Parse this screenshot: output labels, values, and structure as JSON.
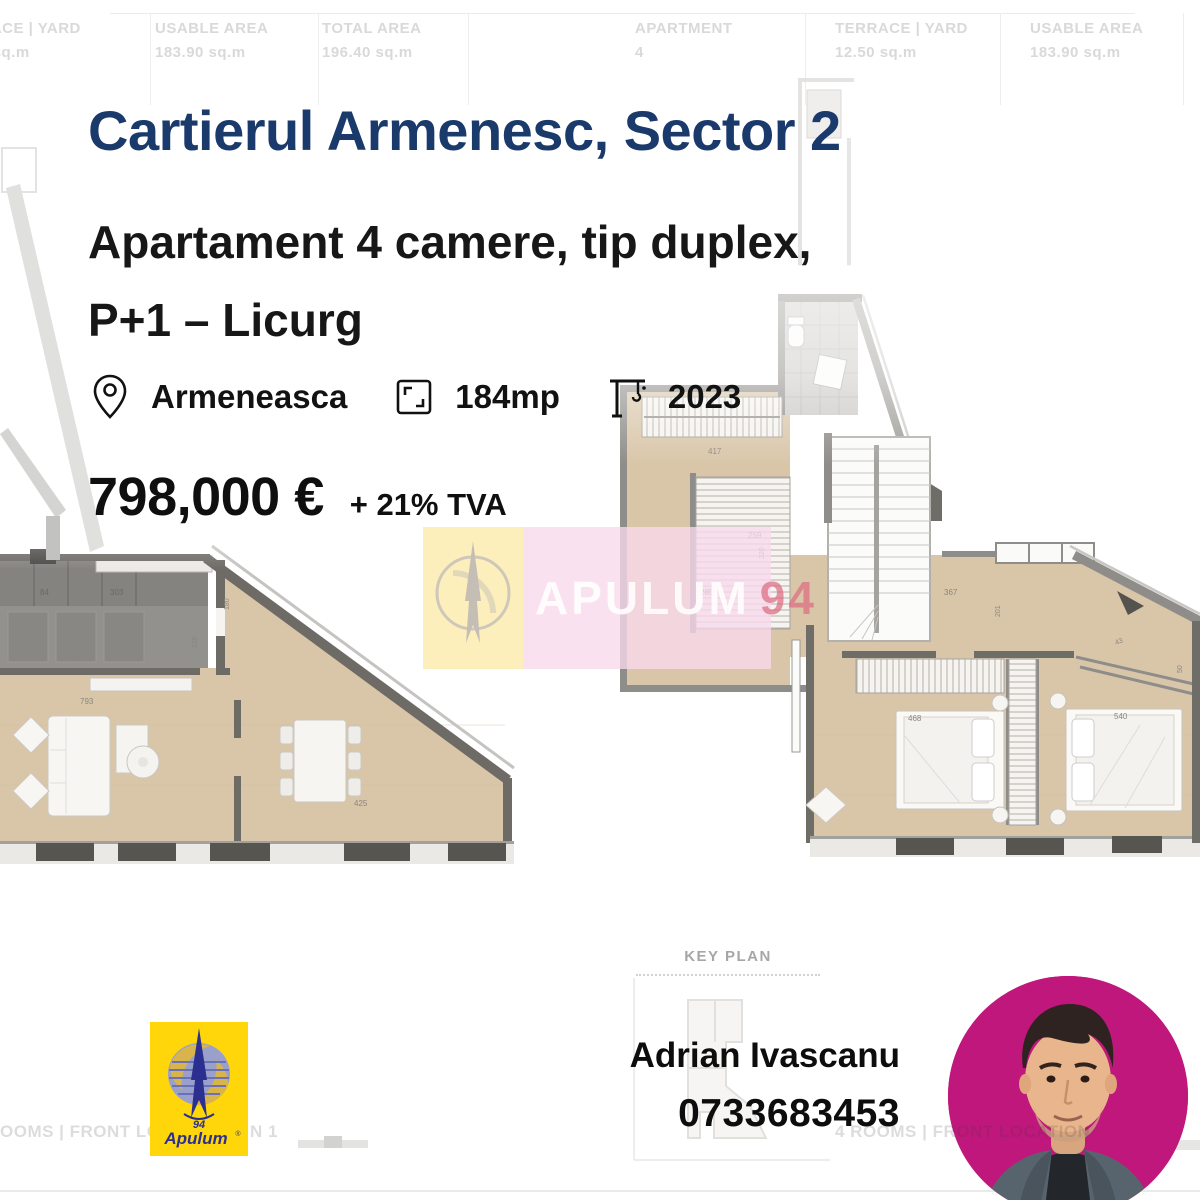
{
  "header_table": {
    "left": [
      {
        "label": "TERRACE | YARD",
        "value": "12.50 sq.m"
      },
      {
        "label": "USABLE AREA",
        "value": "183.90 sq.m"
      },
      {
        "label": "TOTAL AREA",
        "value": "196.40 sq.m"
      }
    ],
    "right": [
      {
        "label": "APARTMENT",
        "value": "4"
      },
      {
        "label": "TERRACE | YARD",
        "value": "12.50 sq.m"
      },
      {
        "label": "USABLE AREA",
        "value": "183.90 sq.m"
      }
    ]
  },
  "listing": {
    "title": "Cartierul Armenesc, Sector 2",
    "subtitle_line1": "Apartament 4 camere, tip duplex,",
    "subtitle_line2": "P+1 – Licurg",
    "location": "Armeneasca",
    "area": "184mp",
    "year": "2023",
    "price": "798,000 €",
    "vat": "+ 21% TVA"
  },
  "watermark": {
    "text": "APULUM",
    "number": "94"
  },
  "key_plan": {
    "label": "KEY PLAN"
  },
  "agent": {
    "name": "Adrian Ivascanu",
    "phone": "0733683453"
  },
  "brand": {
    "logo_number": "94",
    "logo_name": "Apulum",
    "registered": "®"
  },
  "faint": {
    "bottom_left": "OOMS | FRONT LOCAT",
    "bottom_left_tail": "N 1",
    "bottom_right": "4 ROOMS | FRONT LOCATION 1"
  },
  "plans": {
    "left": {
      "dims": [
        "84",
        "303",
        "740",
        "793",
        "425",
        "150",
        "180"
      ]
    },
    "right": {
      "dims": [
        "417",
        "259",
        "320",
        "285",
        "367",
        "201",
        "43",
        "50",
        "468",
        "540"
      ]
    }
  },
  "colors": {
    "navy": "#1A3A6C",
    "magenta": "#C0177C",
    "faint": "#d9d9d9",
    "keyplan": "#a6a6a6",
    "floor": "#D9C6A9",
    "wall": "#6E6B66",
    "logoYellow": "#FFD60A",
    "logoBlue": "#2B2F90"
  }
}
